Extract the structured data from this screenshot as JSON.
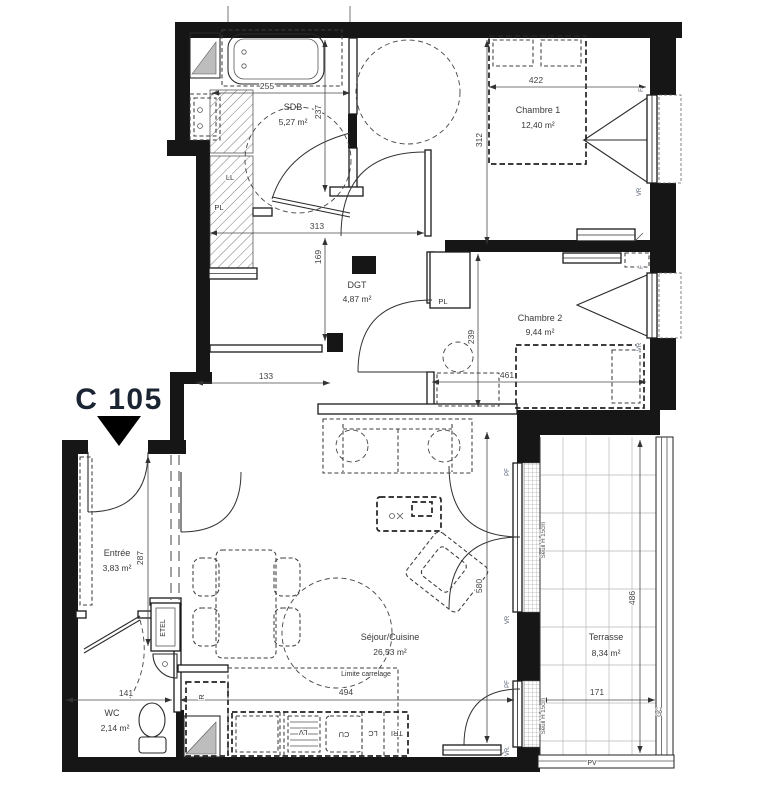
{
  "unit_label": "C 105",
  "rooms": {
    "sdb": {
      "name": "SDB",
      "area": "5,27 m²"
    },
    "chambre1": {
      "name": "Chambre 1",
      "area": "12,40 m²"
    },
    "dgt": {
      "name": "DGT",
      "area": "4,87 m²"
    },
    "chambre2": {
      "name": "Chambre 2",
      "area": "9,44 m²"
    },
    "entree": {
      "name": "Entrée",
      "area": "3,83 m²"
    },
    "sejour": {
      "name": "Séjour/Cuisine",
      "area": "26,53 m²"
    },
    "wc": {
      "name": "WC",
      "area": "2,14 m²"
    },
    "terrasse": {
      "name": "Terrasse",
      "area": "8,34 m²"
    }
  },
  "dims": {
    "sdb_w": "255",
    "sdb_h": "237",
    "ch1_w": "422",
    "ch1_h": "312",
    "dgt_w": "313",
    "dgt_h": "169",
    "hall_w": "133",
    "ch2_h": "239",
    "ch2_w": "461",
    "entree_h": "287",
    "wc_w": "141",
    "sejour_w": "494",
    "sejour_h": "580",
    "terrasse_h": "486",
    "terrasse_w": "171"
  },
  "annot": {
    "limite_carrelage": "Limite carrelage",
    "seuil_1": "Seuil H 15cm",
    "seuil_2": "Seuil H 15cm",
    "pv": "PV",
    "gc": "GC"
  },
  "tags": {
    "ll": "LL",
    "pl_sdb": "PL",
    "pl_ch2": "PL",
    "etel": "ETEL",
    "r": "R",
    "lv": "LV",
    "cu": "CU",
    "lc": "LC",
    "tri": "TRI",
    "f_ch1": "F",
    "vr_ch1": "VR",
    "f_ch2": "F",
    "vr_ch2": "VR",
    "pf_1": "PF",
    "vr_pf1": "VR",
    "pf_2": "PF",
    "vr_pf2": "VR"
  },
  "colors": {
    "wall": "#161616",
    "unit_label": "#1b2433",
    "dim_text": "#444444"
  }
}
